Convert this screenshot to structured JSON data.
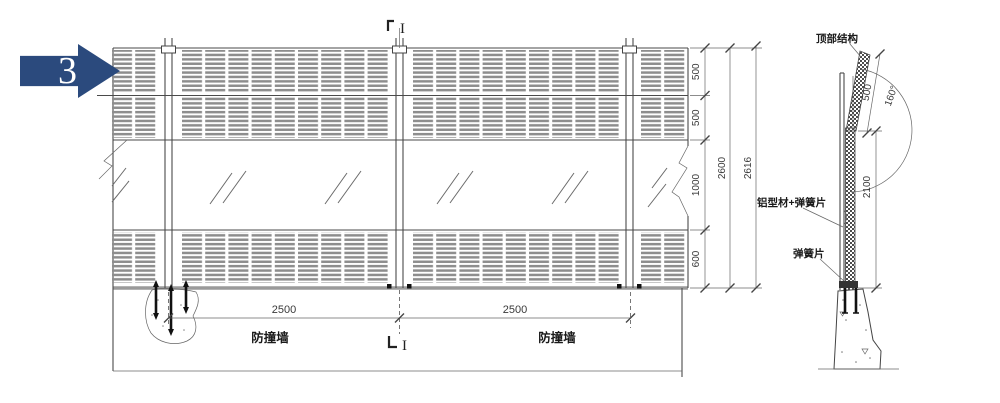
{
  "callout": {
    "number": "3"
  },
  "elevation": {
    "dim_bay_1": "2500",
    "dim_bay_2": "2500",
    "wall_label_1": "防撞墙",
    "wall_label_2": "防撞墙",
    "section_marker_top": "I",
    "section_marker_bottom": "I",
    "dims_right": {
      "seg_top": "500",
      "seg_upper": "500",
      "seg_middle": "1000",
      "seg_bottom": "600",
      "overall_inner": "2600",
      "overall_outer": "2616"
    }
  },
  "section": {
    "label_top": "顶部结构",
    "label_alu": "铝型材+弹簧片",
    "label_spring": "弹簧片",
    "label_wall": "防撞墙",
    "dim_height": "2100",
    "dim_top_panel": "500",
    "dim_angle": "160°"
  },
  "colors": {
    "accent_blue": "#2b4a7d",
    "line": "#4a4a4a",
    "louver_gray": "#8d8d8d",
    "base_gray": "#9a9a9a"
  }
}
